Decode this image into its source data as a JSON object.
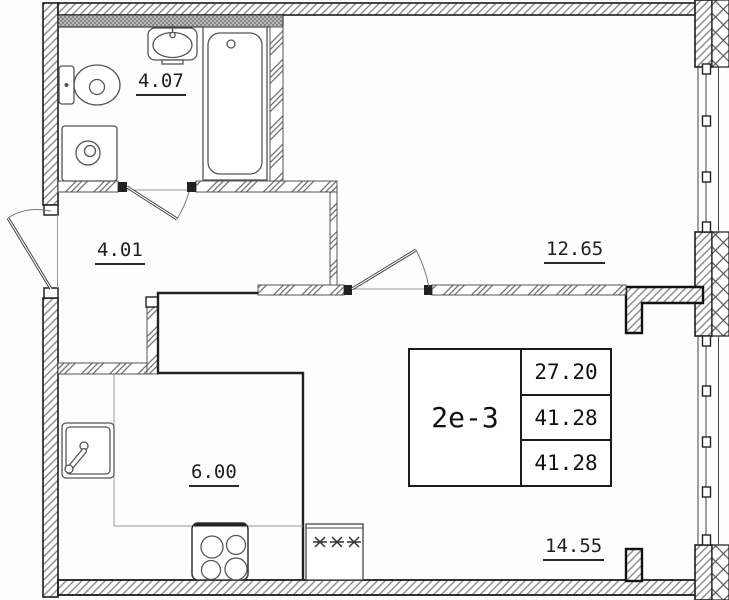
{
  "info_table": {
    "unit_code": "2е-3",
    "values": [
      "27.20",
      "41.28",
      "41.28"
    ]
  },
  "room_areas": {
    "bathroom": "4.07",
    "hallway": "4.01",
    "room": "12.65",
    "kitchen": "6.00",
    "living_kitchen": "14.55"
  },
  "fixtures": [
    "toilet",
    "washing-machine",
    "washbasin",
    "bathtub",
    "kitchen-sink",
    "stove",
    "refrigerator"
  ],
  "colors": {
    "wall_outline": "#1c1c1c",
    "hatch": "#7f7f7f",
    "partition": "#555555",
    "label_text": "#1f1f1f",
    "background": "#fdfdfd"
  }
}
